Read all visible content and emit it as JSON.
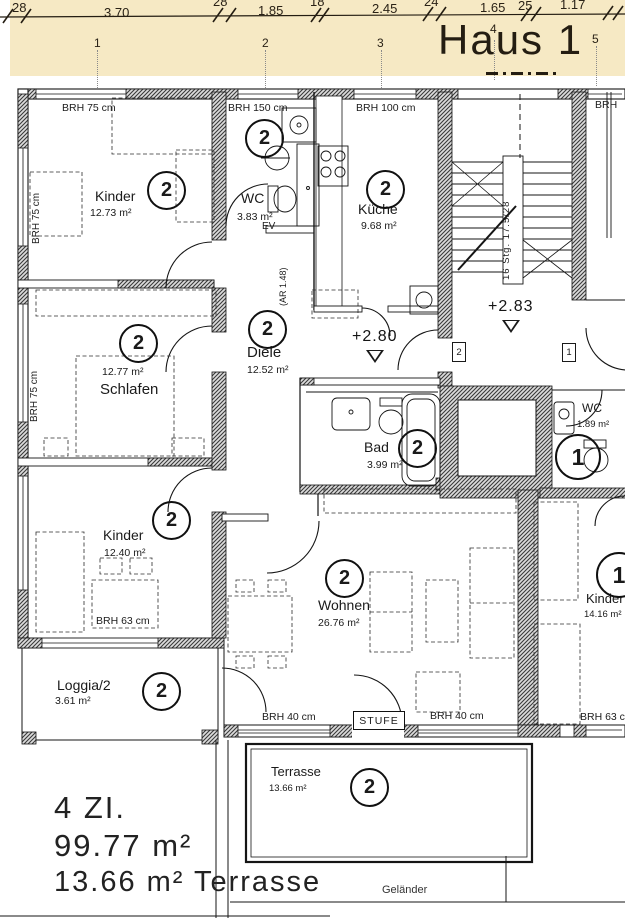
{
  "header": {
    "title": "Haus 1",
    "dimensions": [
      "28",
      "3.70",
      "28",
      "1.85",
      "18",
      "2.45",
      "24",
      "1.65",
      "25",
      "1.17"
    ],
    "axes": [
      "1",
      "2",
      "3",
      "4",
      "5"
    ]
  },
  "rooms": [
    {
      "name": "Kinder",
      "area": "12.73 m²",
      "unit": "2"
    },
    {
      "name": "WC",
      "area": "3.83 m²",
      "unit": "2"
    },
    {
      "name": "Küche",
      "area": "9.68 m²",
      "unit": "2"
    },
    {
      "name": "Schlafen",
      "area": "12.77 m²",
      "unit": "2"
    },
    {
      "name": "Diele",
      "area": "12.52 m²",
      "unit": "2"
    },
    {
      "name": "Bad",
      "area": "3.99 m²",
      "unit": "2"
    },
    {
      "name": "Kinder",
      "area": "12.40 m²",
      "unit": "2"
    },
    {
      "name": "Loggia/2",
      "area": "3.61 m²",
      "unit": "2"
    },
    {
      "name": "Wohnen",
      "area": "26.76 m²",
      "unit": "2"
    },
    {
      "name": "WC",
      "area": "1.89 m²",
      "unit": "1"
    },
    {
      "name": "Kinder",
      "area": "14.16 m²",
      "unit": "1"
    },
    {
      "name": "Terrasse",
      "area": "13.66 m²",
      "unit": "2"
    }
  ],
  "annotations": {
    "brh75top": "BRH 75 cm",
    "brh150": "BRH 150 cm",
    "brh100": "BRH 100 cm",
    "brh75l1": "BRH 75 cm",
    "brh75l2": "BRH 75 cm",
    "brh63k": "BRH 63 cm",
    "brh40a": "BRH 40 cm",
    "brh40b": "BRH 40 cm",
    "brh63b": "BRH 63 cm",
    "brhcut": "BRH",
    "stufe": "STUFE",
    "ev": "EV",
    "ar": "(AR 1.48)",
    "stair": "16 Stg. 17.5/28",
    "lvl280": "+2.80",
    "lvl283": "+2.83",
    "plate2": "2",
    "plate1": "1",
    "gelaender": "Geländer"
  },
  "summary": {
    "l1": "4 ZI.",
    "l2": "99.77 m²",
    "l3": "13.66 m² Terrasse"
  },
  "colors": {
    "banner": "#f6e9c4",
    "ink": "#1a1a1a"
  }
}
